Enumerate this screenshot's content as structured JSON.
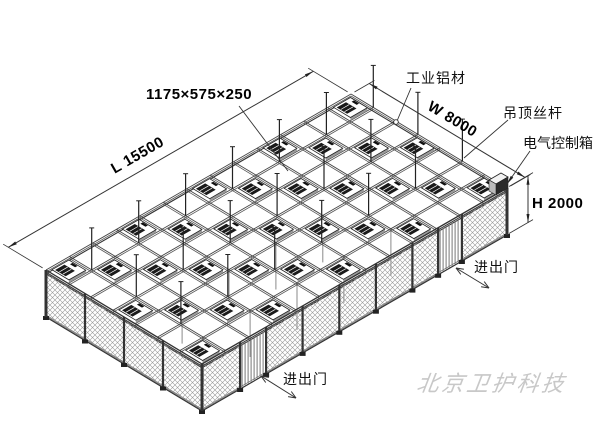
{
  "page": {
    "background": "#ffffff"
  },
  "drawing": {
    "watermark": "北京卫护科技",
    "annotations": {
      "unit_size": "1175×575×250",
      "length_dim": "L 15500",
      "width_dim": "W 8000",
      "height_dim": "H 2000",
      "material": "工业铝材",
      "ceiling_rod": "吊顶丝杆",
      "control_box": "电气控制箱",
      "door": "进出门"
    },
    "dimensions_mm": {
      "length": 15500,
      "width": 8000,
      "height": 2000,
      "unit_size": [
        1175,
        575,
        250
      ]
    },
    "grid": {
      "bays_length": 13,
      "bays_width": 7
    },
    "colors": {
      "line": "#333333",
      "dark": "#1a1a1a",
      "mesh": "#999999",
      "watermark": "#c8c8c8"
    }
  }
}
